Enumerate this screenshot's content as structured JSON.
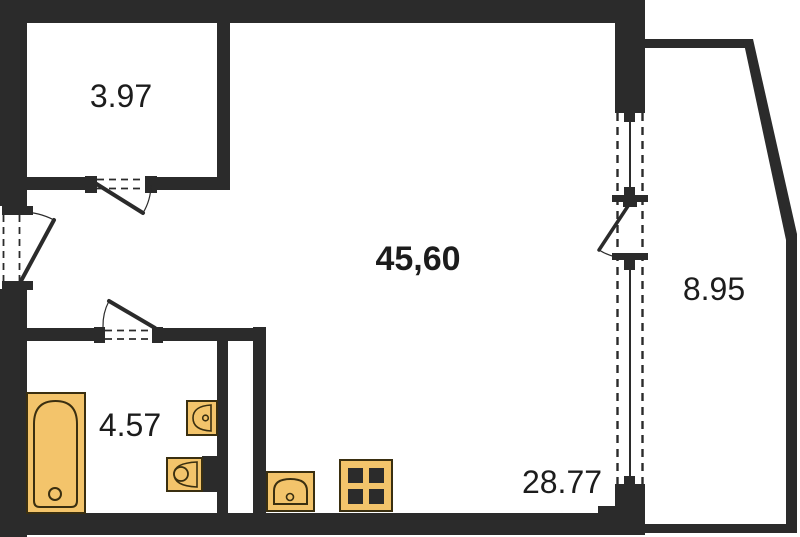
{
  "plan": {
    "colors": {
      "wall": "#2b2b2b",
      "fixture_fill": "#f3c46b",
      "fixture_stroke": "#3a2f10",
      "label": "#1c1c1c",
      "background": "#ffffff"
    },
    "rooms": [
      {
        "name": "closet",
        "area_label": "3.97"
      },
      {
        "name": "studio-room",
        "area_label": "45,60"
      },
      {
        "name": "balcony",
        "area_label": "8.95"
      },
      {
        "name": "bathroom",
        "area_label": "4.57"
      },
      {
        "name": "kitchen-zone",
        "area_label": "28.77"
      }
    ],
    "fixtures": [
      {
        "name": "bathtub"
      },
      {
        "name": "washbasin"
      },
      {
        "name": "toilet"
      },
      {
        "name": "kitchen-sink"
      },
      {
        "name": "stove-4-burner"
      }
    ]
  }
}
